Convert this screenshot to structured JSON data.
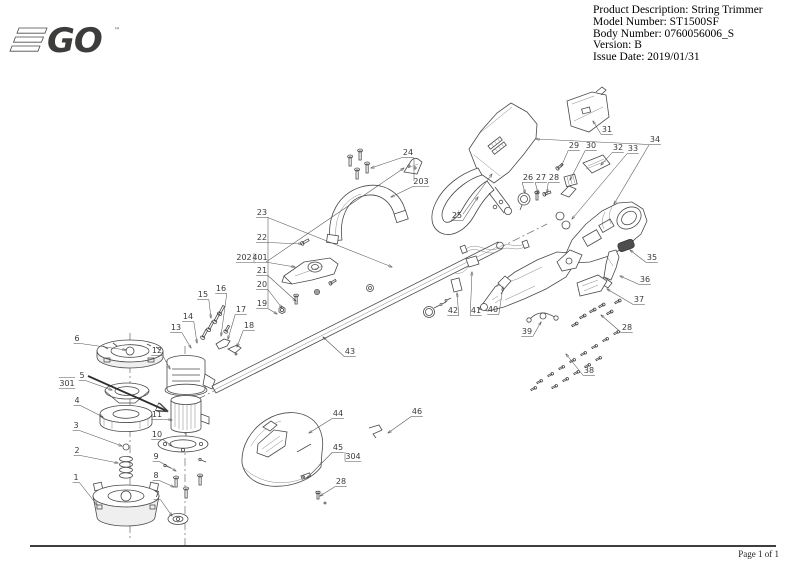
{
  "header": {
    "logo": {
      "text": "GO",
      "tm": "™",
      "green": "#78be20",
      "dark": "#3c3c3b"
    },
    "info_lines": [
      "Product Description: String Trimmer",
      "Model Number: ST1500SF",
      "Body Number: 0760056006_S",
      "Version: B",
      "Issue Date: 2019/01/31"
    ]
  },
  "footer": {
    "page_label": "Page 1 of 1"
  },
  "diagram": {
    "description": "Exploded parts view of EGO ST1500SF string trimmer with numbered callouts",
    "line_color": "#4a4a4a",
    "labels": [
      {
        "t": "6",
        "x": 77,
        "y": 341,
        "ax": 126,
        "ay": 350
      },
      {
        "t": "301",
        "x": 67,
        "y": 386,
        "over": true
      },
      {
        "t": "5",
        "x": 82,
        "y": 378,
        "ax": 112,
        "ay": 390
      },
      {
        "t": "4",
        "x": 77,
        "y": 403,
        "ax": 103,
        "ay": 417
      },
      {
        "t": "3",
        "x": 76,
        "y": 428,
        "ax": 122,
        "ay": 446
      },
      {
        "t": "2",
        "x": 77,
        "y": 453,
        "ax": 118,
        "ay": 463
      },
      {
        "t": "1",
        "x": 76,
        "y": 480,
        "ax": 97,
        "ay": 505
      },
      {
        "t": "12",
        "x": 157,
        "y": 353,
        "ax": 170,
        "ay": 369
      },
      {
        "t": "11",
        "x": 157,
        "y": 417,
        "ax": 172,
        "ay": 420
      },
      {
        "t": "10",
        "x": 157,
        "y": 437,
        "ax": 172,
        "ay": 446
      },
      {
        "t": "9",
        "x": 156,
        "y": 459,
        "ax": 176,
        "ay": 471
      },
      {
        "t": "8",
        "x": 156,
        "y": 478,
        "ax": 174,
        "ay": 487
      },
      {
        "t": "7",
        "x": 157,
        "y": 497,
        "ax": 172,
        "ay": 516
      },
      {
        "t": "13",
        "x": 176,
        "y": 330,
        "ax": 191,
        "ay": 348
      },
      {
        "t": "14",
        "x": 188,
        "y": 319,
        "ax": 197,
        "ay": 343
      },
      {
        "t": "15",
        "x": 203,
        "y": 297,
        "ax": 211,
        "ay": 318
      },
      {
        "t": "16",
        "x": 221,
        "y": 291,
        "ax": 221,
        "ay": 336
      },
      {
        "t": "17",
        "x": 241,
        "y": 312,
        "ax": 228,
        "ay": 339
      },
      {
        "t": "18",
        "x": 249,
        "y": 328,
        "ax": 237,
        "ay": 347
      },
      {
        "t": "23",
        "x": 262,
        "y": 215,
        "ax": 392,
        "ay": 267
      },
      {
        "t": "22",
        "x": 262,
        "y": 240,
        "ax": 302,
        "ay": 244
      },
      {
        "t": "202",
        "x": 244,
        "y": 260
      },
      {
        "t": "401",
        "x": 260,
        "y": 260,
        "ax": 295,
        "ay": 267
      },
      {
        "t": "21",
        "x": 262,
        "y": 273,
        "ax": 296,
        "ay": 301
      },
      {
        "t": "20",
        "x": 262,
        "y": 287,
        "ax": 282,
        "ay": 308
      },
      {
        "t": "19",
        "x": 262,
        "y": 306,
        "ax": 277,
        "ay": 314
      },
      {
        "t": "24",
        "x": 408,
        "y": 155,
        "ax": 371,
        "ay": 168
      },
      {
        "t": "203",
        "x": 421,
        "y": 184,
        "ax": 391,
        "ay": 197
      },
      {
        "t": "25",
        "x": 457,
        "y": 218,
        "ax": 478,
        "ay": 197
      },
      {
        "t": "26",
        "x": 528,
        "y": 180,
        "ax": 525,
        "ay": 193
      },
      {
        "t": "27",
        "x": 541,
        "y": 180,
        "ax": 538,
        "ay": 193
      },
      {
        "t": "28",
        "x": 554,
        "y": 180,
        "ax": 547,
        "ay": 193
      },
      {
        "t": "29",
        "x": 574,
        "y": 148,
        "ax": 561,
        "ay": 167
      },
      {
        "t": "30",
        "x": 591,
        "y": 148,
        "ax": 570,
        "ay": 180
      },
      {
        "t": "31",
        "x": 607,
        "y": 132,
        "ax": 593,
        "ay": 121
      },
      {
        "t": "32",
        "x": 618,
        "y": 150,
        "ax": 601,
        "ay": 165
      },
      {
        "t": "33",
        "x": 633,
        "y": 151,
        "ax": 572,
        "ay": 219
      },
      {
        "t": "34",
        "x": 655,
        "y": 142,
        "ax": 536,
        "ay": 139
      },
      {
        "t": "35",
        "x": 652,
        "y": 260,
        "ax": 630,
        "ay": 250
      },
      {
        "t": "36",
        "x": 645,
        "y": 282,
        "ax": 620,
        "ay": 276
      },
      {
        "t": "37",
        "x": 639,
        "y": 302,
        "ax": 607,
        "ay": 289
      },
      {
        "t": "28",
        "x": 627,
        "y": 330,
        "ax": 601,
        "ay": 315
      },
      {
        "t": "39",
        "x": 527,
        "y": 334,
        "ax": 541,
        "ay": 322
      },
      {
        "t": "38",
        "x": 589,
        "y": 373,
        "ax": 566,
        "ay": 354
      },
      {
        "t": "40",
        "x": 493,
        "y": 312,
        "ax": 503,
        "ay": 287
      },
      {
        "t": "41",
        "x": 476,
        "y": 313,
        "ax": 472,
        "ay": 272
      },
      {
        "t": "42",
        "x": 453,
        "y": 313,
        "ax": 457,
        "ay": 293
      },
      {
        "t": "43",
        "x": 350,
        "y": 354,
        "ax": 323,
        "ay": 337
      },
      {
        "t": "44",
        "x": 338,
        "y": 416,
        "ax": 309,
        "ay": 433
      },
      {
        "t": "45",
        "x": 338,
        "y": 450,
        "ax": 307,
        "ay": 478
      },
      {
        "t": "304",
        "x": 353,
        "y": 459
      },
      {
        "t": "28",
        "x": 341,
        "y": 484,
        "ax": 320,
        "ay": 496
      },
      {
        "t": "46",
        "x": 417,
        "y": 414,
        "ax": 388,
        "ay": 433
      }
    ],
    "extra_lines": [
      {
        "x1": 254,
        "y1": 253,
        "x2": 254,
        "y2": 262
      },
      {
        "x1": 268,
        "y1": 217,
        "x2": 268,
        "y2": 308
      },
      {
        "x1": 414,
        "y1": 158,
        "x2": 414,
        "y2": 181
      },
      {
        "x1": 345,
        "y1": 452,
        "x2": 345,
        "y2": 461
      },
      {
        "x1": 649,
        "y1": 145,
        "x2": 614,
        "y2": 204,
        "arrow": true
      },
      {
        "x1": 463,
        "y1": 214,
        "x2": 492,
        "y2": 174,
        "arrow": true
      },
      {
        "x1": 266,
        "y1": 262,
        "x2": 404,
        "y2": 168,
        "arrow": true
      },
      {
        "x1": 88,
        "y1": 376,
        "x2": 167,
        "y2": 411,
        "arrow": true,
        "bold": true
      }
    ]
  }
}
